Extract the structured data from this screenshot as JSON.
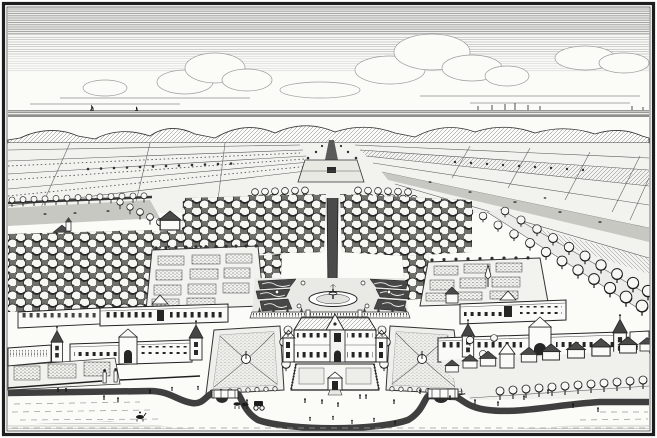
{
  "artwork": {
    "type": "engraving",
    "medium": "black-and-white line engraving",
    "description": "Bird's-eye view engraving of a formal Dutch country estate: central mansion with forecourt, symmetrical parterre gardens with fountains, orchards, walled kitchen gardens, service wings with spired towers, a long central avenue to the horizon, polder fields, dunes and sea beyond, village houses along a tree-lined road, and a curving moat with strolling figures, a carriage and riders in the foreground."
  },
  "colors": {
    "paper": "#fbfbf8",
    "ink": "#1e1e1e",
    "mid": "#555555",
    "light": "#9a9a9a",
    "dark": "#3f3f3f",
    "field": "#f2f2ee",
    "orchard": "#6f6f6a",
    "meadow": "#c8c8c3"
  },
  "scene": {
    "elements": [
      "hatched sky with cumulus clouds",
      "sea horizon with two sailboats",
      "distant town skyline with spires",
      "dune ridge",
      "polder fields with furrows, crop rows and grazing animals",
      "rows of trees along field boundaries",
      "long central tree-lined avenue with far gate clearing",
      "dense orchards in offset rows",
      "walled kitchen gardens with rectangular beds",
      "garden obelisk and pavilion",
      "rear formal garden with scroll parterres, topiary and tiered fountain in round basin",
      "central two-storey mansion with pediment and hipped roof",
      "forecourt with balustrade and gate",
      "square parterre gardens with fountains flanking the forecourt",
      "long service wings with window rows, gate pavilions and spired corner towers",
      "boundary walls with gate piers",
      "diagonal tree-lined road",
      "village cottages with row of trees",
      "curving moat with two bridges",
      "tiny figures, horse-drawn carriage and riders on the banks"
    ],
    "figure_count_hint": "about two dozen tiny staffage figures",
    "frame": "double ruled black border"
  }
}
